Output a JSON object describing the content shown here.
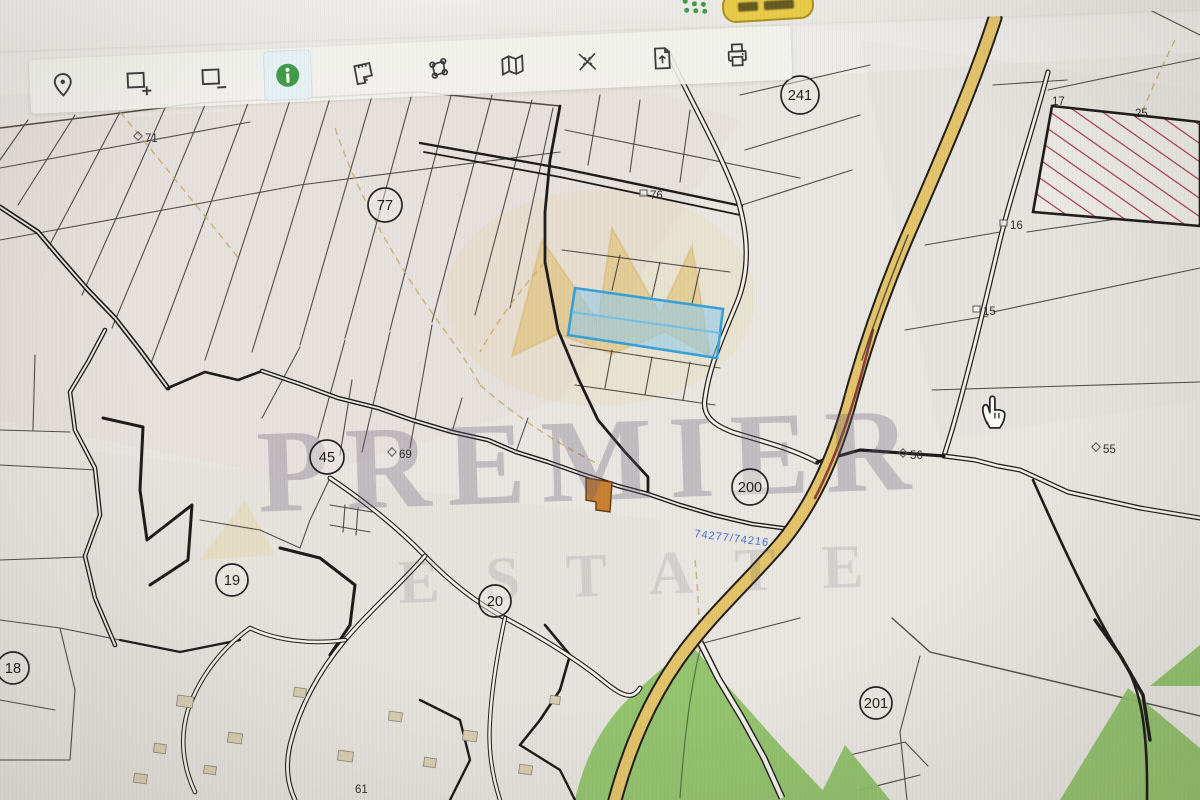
{
  "app": {
    "top_button": {
      "note": "partially-visible yellow pill button, text cut off"
    },
    "toolbar_tools": [
      {
        "id": "location-pin-tool"
      },
      {
        "id": "zoom-in-rect-tool"
      },
      {
        "id": "zoom-out-rect-tool"
      },
      {
        "id": "info-tool",
        "active": true
      },
      {
        "id": "measure-area-tool"
      },
      {
        "id": "polygon-select-tool"
      },
      {
        "id": "map-layers-tool"
      },
      {
        "id": "road-network-tool"
      },
      {
        "id": "export-document-tool"
      },
      {
        "id": "print-tool"
      }
    ]
  },
  "map": {
    "watermark": {
      "line1": "PREMIER",
      "line2": "ESTATE"
    },
    "road_label": {
      "text": "74277/74216",
      "color": "#4a6fd4"
    },
    "circled_labels": [
      {
        "text": "241",
        "x": 800,
        "y": 95,
        "r": 19
      },
      {
        "text": "77",
        "x": 385,
        "y": 205,
        "r": 17
      },
      {
        "text": "45",
        "x": 327,
        "y": 457,
        "r": 17
      },
      {
        "text": "19",
        "x": 232,
        "y": 580,
        "r": 16
      },
      {
        "text": "18",
        "x": 13,
        "y": 668,
        "r": 16
      },
      {
        "text": "20",
        "x": 495,
        "y": 601,
        "r": 16
      },
      {
        "text": "200",
        "x": 750,
        "y": 487,
        "r": 18
      },
      {
        "text": "201",
        "x": 876,
        "y": 703,
        "r": 16
      }
    ],
    "point_labels": [
      {
        "text": "71",
        "x": 150,
        "y": 141,
        "marker": "diamond"
      },
      {
        "text": "76",
        "x": 655,
        "y": 198,
        "marker": "square"
      },
      {
        "text": "69",
        "x": 404,
        "y": 457,
        "marker": "diamond"
      },
      {
        "text": "56",
        "x": 915,
        "y": 458,
        "marker": "diamond"
      },
      {
        "text": "55",
        "x": 1108,
        "y": 452,
        "marker": "diamond"
      },
      {
        "text": "16",
        "x": 1015,
        "y": 228,
        "marker": "square"
      },
      {
        "text": "15",
        "x": 988,
        "y": 314,
        "marker": "square"
      },
      {
        "text": "17",
        "x": 1057,
        "y": 104,
        "marker": "none"
      },
      {
        "text": "25",
        "x": 1140,
        "y": 116,
        "marker": "none"
      },
      {
        "text": "61",
        "x": 360,
        "y": 792,
        "marker": "none"
      }
    ],
    "colors": {
      "map_bg": "#e9e6e1",
      "road_yellow": "#e3c368",
      "selected_parcel_fill": "#a9d6ef",
      "selected_parcel_stroke": "#35a0d6",
      "hatch_red": "#a83848",
      "green_area": "#8cc063",
      "building_orange": "#c87f2e",
      "watermark_gold": "#deb24a",
      "info_green": "#3f9b47",
      "button_yellow": "#e7ca45"
    }
  }
}
